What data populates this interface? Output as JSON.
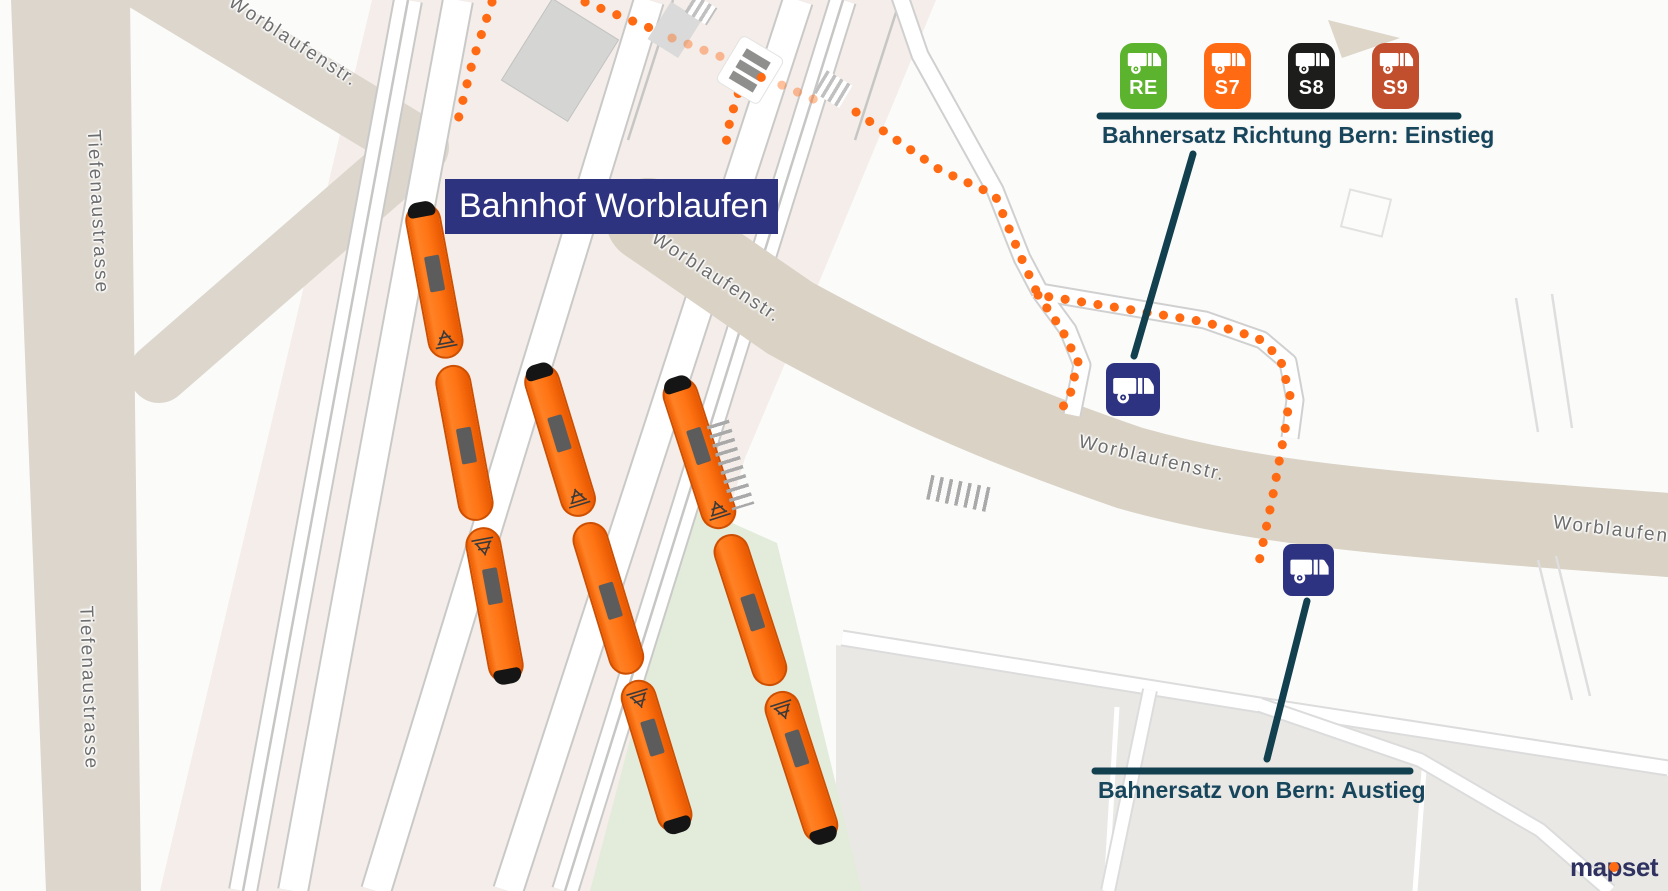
{
  "station": {
    "label": "Bahnhof Worblaufen"
  },
  "streets": {
    "tiefenaustrasse_upper": "Tiefenaustrasse",
    "tiefenaustrasse_lower": "Tiefenaustrasse",
    "worblaufenstr_top_left": "Worblaufenstr.",
    "worblaufenstr_bridge": "Worblaufenstr.",
    "worblaufenstr_center": "Worblaufenstr.",
    "worblaufenstr_right_edge": "Worblaufens"
  },
  "replacement_service": {
    "lines": [
      {
        "id": "RE",
        "color": "#5cb32d"
      },
      {
        "id": "S7",
        "color": "#ff6a13"
      },
      {
        "id": "S8",
        "color": "#1d1d1b"
      },
      {
        "id": "S9",
        "color": "#c14e2c"
      }
    ],
    "boarding_note": "Bahnersatz Richtung Bern: Einstieg",
    "alighting_note": "Bahnersatz von Bern: Austieg"
  },
  "branding": {
    "logo_prefix": "ma",
    "logo_p": "p",
    "logo_suffix": "set"
  },
  "theme": {
    "annotation_navy": "#2e3381",
    "annotation_teal": "#12404f",
    "train_orange": "#ff7414",
    "dot_orange": "#ff6a13",
    "road_tan": "#d9d2c5",
    "rail_pink": "#f4ede9",
    "green_area": "#e3ecdb"
  }
}
